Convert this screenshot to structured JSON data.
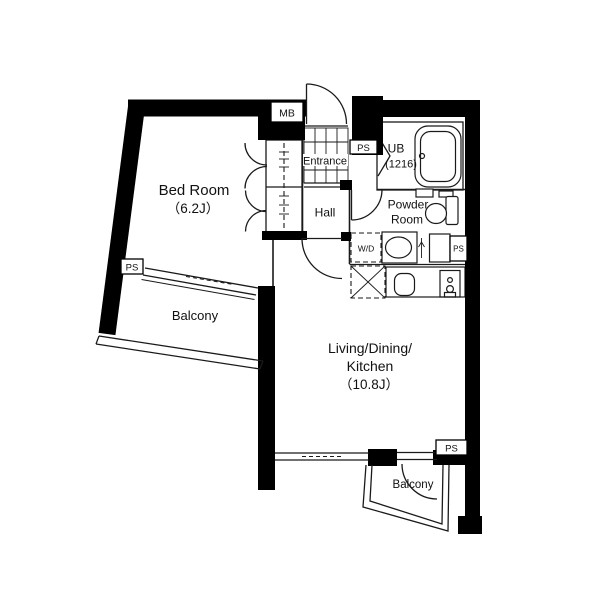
{
  "plan": {
    "rooms": {
      "bedroom": {
        "name": "Bed Room",
        "size": "（6.2J）"
      },
      "ldk": {
        "line1": "Living/Dining/",
        "line2": "Kitchen",
        "size": "（10.8J）"
      },
      "entrance": {
        "name": "Entrance"
      },
      "hall": {
        "name": "Hall"
      },
      "unit_bath": {
        "name": "UB",
        "size": "(1216)"
      },
      "powder_room": {
        "line1": "Powder",
        "line2": "Room"
      },
      "balcony_west": {
        "name": "Balcony"
      },
      "balcony_south": {
        "name": "Balcony"
      }
    },
    "fixtures": {
      "washer_dryer": "W/D"
    },
    "labels": {
      "pipe_space": "PS",
      "meter_box": "MB"
    },
    "colors": {
      "wall": "#000000",
      "line": "#1a1a1a",
      "background": "#ffffff",
      "text": "#111111"
    }
  }
}
